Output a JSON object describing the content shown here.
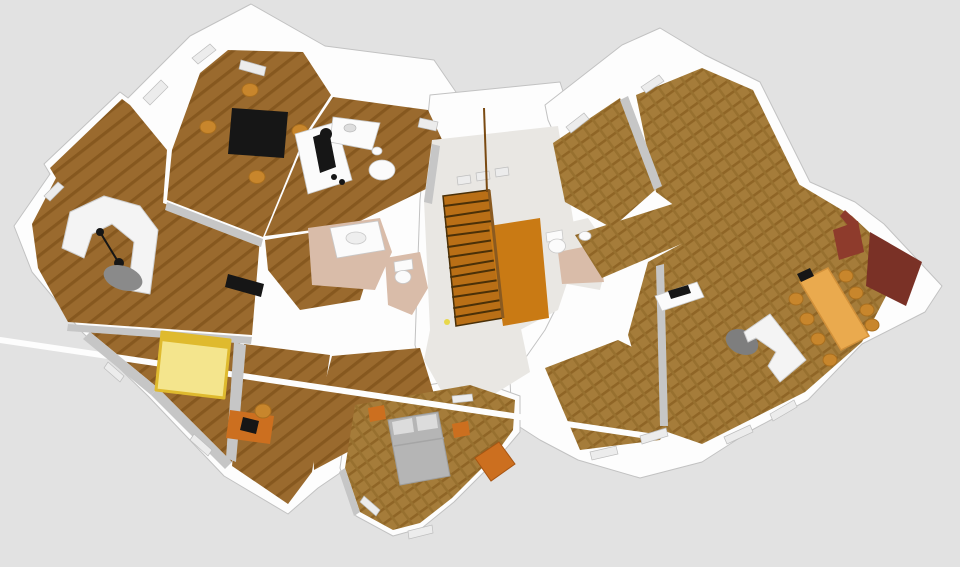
{
  "scene": {
    "type": "3d-floorplan-render",
    "background": "#e2e2e2",
    "colors": {
      "wall": "#fdfdfd",
      "wall_shade": "#c6c6c6",
      "wood": "#9a6a2e",
      "wood_stripe": "#86581f",
      "wood_right": "#a57c3a",
      "wood_right_stripe": "#8f6526",
      "wood_right_cross": "#97702f",
      "tile": "#d9bca9",
      "entry_floor": "#e9e7e3",
      "stairs": "#b96f16",
      "stairs_edge": "#4a3008",
      "landing": "#c97a14",
      "bed_yellow": "#f4e58d",
      "bed_yellow_edge": "#dfba2e",
      "bed_gray": "#b5b5b5",
      "pillow": "#dcdcdc",
      "sofa": "#f4f4f4",
      "black": "#161616",
      "chair": "#c8862c",
      "chair_dark": "#a96f1f",
      "desk": "#cc6f1f",
      "long_table": "#eaaa4e",
      "long_table_edge": "#d2913a",
      "rug": "#8a8a8a",
      "rug_dark": "#7e7e7e",
      "brick": "#8e3b2c",
      "brick_dark": "#7a3126",
      "fixture": "#fbfbfb",
      "marker_yellow": "#e8d84a"
    },
    "rooms": [
      {
        "id": "dining-room",
        "furniture": [
          "black square table",
          "4 wooden chairs"
        ]
      },
      {
        "id": "kitchen",
        "furniture": [
          "L counters",
          "stool",
          "cooktop",
          "sink",
          "round table"
        ]
      },
      {
        "id": "living-room",
        "furniture": [
          "white corner sofa",
          "floor lamp",
          "gray rug"
        ]
      },
      {
        "id": "bedroom-yellow",
        "furniture": [
          "yellow double bed",
          "tv"
        ]
      },
      {
        "id": "office",
        "furniture": [
          "desk",
          "computer",
          "chair"
        ]
      },
      {
        "id": "bathroom",
        "furniture": [
          "vanity",
          "washbasin"
        ]
      },
      {
        "id": "wc",
        "furniture": [
          "toilet"
        ]
      },
      {
        "id": "stair-hall",
        "furniture": [
          "staircase",
          "landing"
        ]
      },
      {
        "id": "bathroom-2",
        "furniture": [
          "toilet",
          "sink"
        ]
      },
      {
        "id": "room-northeast-1",
        "furniture": []
      },
      {
        "id": "room-northeast-2",
        "furniture": []
      },
      {
        "id": "meeting-room",
        "furniture": [
          "long table",
          "8 chairs",
          "white sofa",
          "rug",
          "console"
        ]
      },
      {
        "id": "room-southeast",
        "furniture": []
      },
      {
        "id": "bedroom-gray",
        "furniture": [
          "gray double bed",
          "2 nightstands",
          "sideboard"
        ]
      }
    ]
  }
}
